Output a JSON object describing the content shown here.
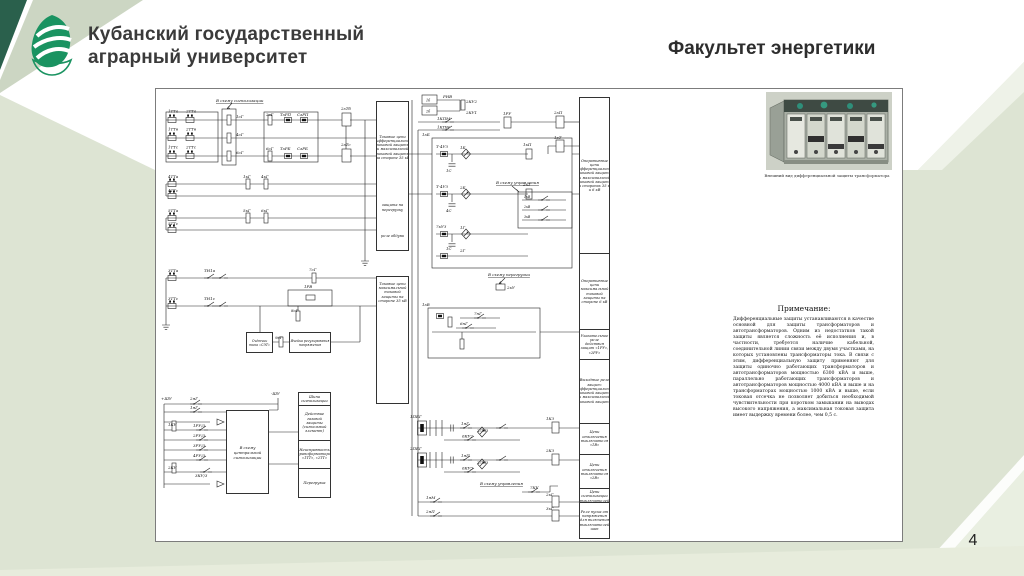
{
  "slide": {
    "university_line1": "Кубанский государственный",
    "university_line2": "аграрный университет",
    "faculty_title": "Факультет  энергетики",
    "page_number": "4"
  },
  "photo_caption": "Внешний вид дифференциальной защиты трансформатора",
  "note": {
    "title": "Примечание:",
    "body": "Дифференциальные защиты устанавливаются в качестве основной для защиты трансформаторов и автотрансформаторов. Одним из недостатков такой защиты является сложность её исполнения и, в частности, требуется наличие кабельной, соединительной линии связи между двумя участками, на которых установлены трансформаторы тока. В связи с этим, дифференциальную защиту применяют для защиты одиночно работающих трансформаторов и автотрансформаторов мощностью 6300 кВА и выше, параллельно работающих трансформаторов и автотрансформаторов мощностью 4000 кВА и выше и на трансформаторах мощностью 1000 кВА и выше, если токовая отсечка не позволяет добиться необходимой чувствительности при коротком замыкании на выводах высокого напряжения, а максимальная токовая защита имеет выдержку времени более, чем 0,5 с."
  },
  "diagram": {
    "columns": {
      "colA1": [
        [
          "Токовые цепи дифференциальной токовой защиты и максимальной токовой защиты на стороне 35 кВ"
        ],
        [
          "защита на перегрузку"
        ],
        [
          "реле обдува"
        ]
      ],
      "colA2": [
        [
          "Токовые цепи максимальной токовой защиты на стороне 35 кВ"
        ]
      ],
      "colB": [
        [
          "Оперативные цепи дифференциальной токовой защиты и максимальной токовой защиты на сторонах 35 кВ и 6 кВ"
        ],
        [
          "Оперативные цепи максимальной токовой защиты на стороне 6 кВ"
        ],
        [
          "Указательное реле действия защит «1РУ», «2РУ»"
        ],
        [
          "Выходные реле защит: дифференциальной токовой защиты и максимальной токовой защиты"
        ],
        [
          "Цепи отключения выключателя «1В»"
        ],
        [
          "Цепи отключения выключателя «2В»"
        ],
        [
          "Цепи сигнализации выключателей"
        ],
        [
          "Реле пуска от напряжения для включения выключателей шин"
        ]
      ],
      "colC": [
        [
          "Шина сигнализации"
        ],
        [
          "Действие газовой защиты (сигнальный элемент)"
        ],
        [
          "Неисправность трансформаторов «1ТТ», «2ТТ»"
        ],
        [
          "Перегрузка"
        ]
      ]
    },
    "boxes": {
      "counter": "Счётчик типа «СЭТ»",
      "regulator": "Ячейка регулирования напряжения",
      "central_signal": "В схему центральной сигнализации"
    },
    "labels": [
      {
        "t": "1ТТа",
        "x": 8,
        "y": 20.5
      },
      {
        "t": "2ТТа",
        "x": 26,
        "y": 20.5
      },
      {
        "t": "1ТТв",
        "x": 8,
        "y": 38.5
      },
      {
        "t": "2ТТв",
        "x": 26,
        "y": 38.5
      },
      {
        "t": "1ТТс",
        "x": 8,
        "y": 56.5
      },
      {
        "t": "2ТТс",
        "x": 26,
        "y": 56.5
      },
      {
        "t": "В схему сигнализации",
        "x": 56,
        "y": 10,
        "u": 1
      },
      {
        "t": "1сГ",
        "x": 76,
        "y": 26
      },
      {
        "t": "4сГ",
        "x": 76,
        "y": 44
      },
      {
        "t": "6сГ",
        "x": 76,
        "y": 62
      },
      {
        "t": "2сГ",
        "x": 106,
        "y": 24
      },
      {
        "t": "ТзРП",
        "x": 120,
        "y": 24
      },
      {
        "t": "СзРП",
        "x": 137,
        "y": 24
      },
      {
        "t": "6сГ",
        "x": 106,
        "y": 58
      },
      {
        "t": "ТзРБ",
        "x": 120,
        "y": 58
      },
      {
        "t": "СзРБ",
        "x": 137,
        "y": 58
      },
      {
        "t": "2зТб",
        "x": 181,
        "y": 18
      },
      {
        "t": "2зТс",
        "x": 181,
        "y": 54
      },
      {
        "t": "4ТТа",
        "x": 8,
        "y": 86
      },
      {
        "t": "1кГ",
        "x": 83,
        "y": 86
      },
      {
        "t": "4кГ",
        "x": 101,
        "y": 86
      },
      {
        "t": "4ТТс",
        "x": 8,
        "y": 100
      },
      {
        "t": "5ТТа",
        "x": 8,
        "y": 120
      },
      {
        "t": "5кГ",
        "x": 83,
        "y": 120
      },
      {
        "t": "6кГ",
        "x": 101,
        "y": 120
      },
      {
        "t": "5ТТс",
        "x": 8,
        "y": 133
      },
      {
        "t": "3ТТа",
        "x": 8,
        "y": 180
      },
      {
        "t": "ТН1а",
        "x": 44,
        "y": 180
      },
      {
        "t": "7сГ",
        "x": 149,
        "y": 179
      },
      {
        "t": "3ТТс",
        "x": 8,
        "y": 208
      },
      {
        "t": "ТН1с",
        "x": 44,
        "y": 208
      },
      {
        "t": "1РВ",
        "x": 144,
        "y": 196
      },
      {
        "t": "8сГ",
        "x": 131,
        "y": 220
      },
      {
        "t": "7кГ",
        "x": 97,
        "y": 247
      },
      {
        "t": "9сГ",
        "x": 115,
        "y": 247
      },
      {
        "t": "+ШУ",
        "x": 1,
        "y": 308
      },
      {
        "t": "-ШУ",
        "x": 111,
        "y": 303
      },
      {
        "t": "2яГ",
        "x": 30,
        "y": 308
      },
      {
        "t": "1яГ",
        "x": 30,
        "y": 317
      },
      {
        "t": "1КУ",
        "x": 8,
        "y": 334
      },
      {
        "t": "1РУ/3",
        "x": 33,
        "y": 335
      },
      {
        "t": "2РУ/3",
        "x": 33,
        "y": 345
      },
      {
        "t": "3РУ/3",
        "x": 33,
        "y": 355
      },
      {
        "t": "4РУ/3",
        "x": 33,
        "y": 365
      },
      {
        "t": "2КУ",
        "x": 8,
        "y": 377
      },
      {
        "t": "3КУ/3",
        "x": 35,
        "y": 385
      },
      {
        "t": "1б",
        "x": 266,
        "y": 9.5,
        "s": 3.4
      },
      {
        "t": "2б",
        "x": 266,
        "y": 20.5,
        "s": 3.4
      },
      {
        "t": "РНВ",
        "x": 283,
        "y": 6
      },
      {
        "t": "2КУ2",
        "x": 306,
        "y": 11
      },
      {
        "t": "2КУ1",
        "x": 306,
        "y": 22
      },
      {
        "t": "1КПМ",
        "x": 277,
        "y": 28
      },
      {
        "t": "1КПН",
        "x": 277,
        "y": 36.5
      },
      {
        "t": "1РУ",
        "x": 343,
        "y": 23
      },
      {
        "t": "2зП",
        "x": 394,
        "y": 22
      },
      {
        "t": "1зТ",
        "x": 394,
        "y": 47
      },
      {
        "t": "1зБ",
        "x": 262,
        "y": 44
      },
      {
        "t": "Т-4УЗ",
        "x": 276,
        "y": 56
      },
      {
        "t": "1Б",
        "x": 300,
        "y": 57
      },
      {
        "t": "1С",
        "x": 286,
        "y": 80
      },
      {
        "t": "Т-4УЗ",
        "x": 276,
        "y": 96
      },
      {
        "t": "2Б",
        "x": 300,
        "y": 97
      },
      {
        "t": "4С",
        "x": 286,
        "y": 120
      },
      {
        "t": "7кУЗ",
        "x": 276,
        "y": 136
      },
      {
        "t": "1Г",
        "x": 300,
        "y": 137
      },
      {
        "t": "1С",
        "x": 286,
        "y": 158
      },
      {
        "t": "2Г",
        "x": 300,
        "y": 160
      },
      {
        "t": "1кП",
        "x": 363,
        "y": 54
      },
      {
        "t": "2кТ",
        "x": 363,
        "y": 94
      },
      {
        "t": "В схему управления",
        "x": 336,
        "y": 92,
        "u": 1
      },
      {
        "t": "1кВ",
        "x": 364,
        "y": 106,
        "s": 3.2
      },
      {
        "t": "2кВ",
        "x": 364,
        "y": 116,
        "s": 3.2
      },
      {
        "t": "3кВ",
        "x": 364,
        "y": 126,
        "s": 3.2
      },
      {
        "t": "1зВ",
        "x": 262,
        "y": 214
      },
      {
        "t": "В схему перегрузки",
        "x": 328,
        "y": 184,
        "u": 1
      },
      {
        "t": "2кУ",
        "x": 347,
        "y": 197
      },
      {
        "t": "7нГ",
        "x": 314,
        "y": 223
      },
      {
        "t": "6нГ",
        "x": 300,
        "y": 233
      },
      {
        "t": "1ПБГ",
        "x": 250,
        "y": 326
      },
      {
        "t": "1яГ",
        "x": 301,
        "y": 333
      },
      {
        "t": "2ЛУЗ",
        "x": 317,
        "y": 340
      },
      {
        "t": "6КУ2",
        "x": 302,
        "y": 345.5
      },
      {
        "t": "1КЗ",
        "x": 386,
        "y": 328
      },
      {
        "t": "2ПБГ",
        "x": 250,
        "y": 358
      },
      {
        "t": "1яП",
        "x": 301,
        "y": 365
      },
      {
        "t": "2ЛУЗ",
        "x": 317,
        "y": 372
      },
      {
        "t": "6КУ3",
        "x": 302,
        "y": 377.5
      },
      {
        "t": "2КЗ",
        "x": 386,
        "y": 360
      },
      {
        "t": "В схему управления",
        "x": 320,
        "y": 393,
        "u": 1
      },
      {
        "t": "7КУ",
        "x": 370,
        "y": 397
      },
      {
        "t": "1яМ",
        "x": 266,
        "y": 407
      },
      {
        "t": "2кГ",
        "x": 386,
        "y": 404
      },
      {
        "t": "2яП",
        "x": 266,
        "y": 421
      },
      {
        "t": "3кГ",
        "x": 386,
        "y": 418
      }
    ]
  },
  "colors": {
    "background": "#dde4d3",
    "corner_dark_green": "#2a604c",
    "corner_pale_stripe": "#ccd6c3",
    "logo_green": "#1a9361",
    "title_text": "#3a3a3a",
    "line_ink": "#222222"
  }
}
